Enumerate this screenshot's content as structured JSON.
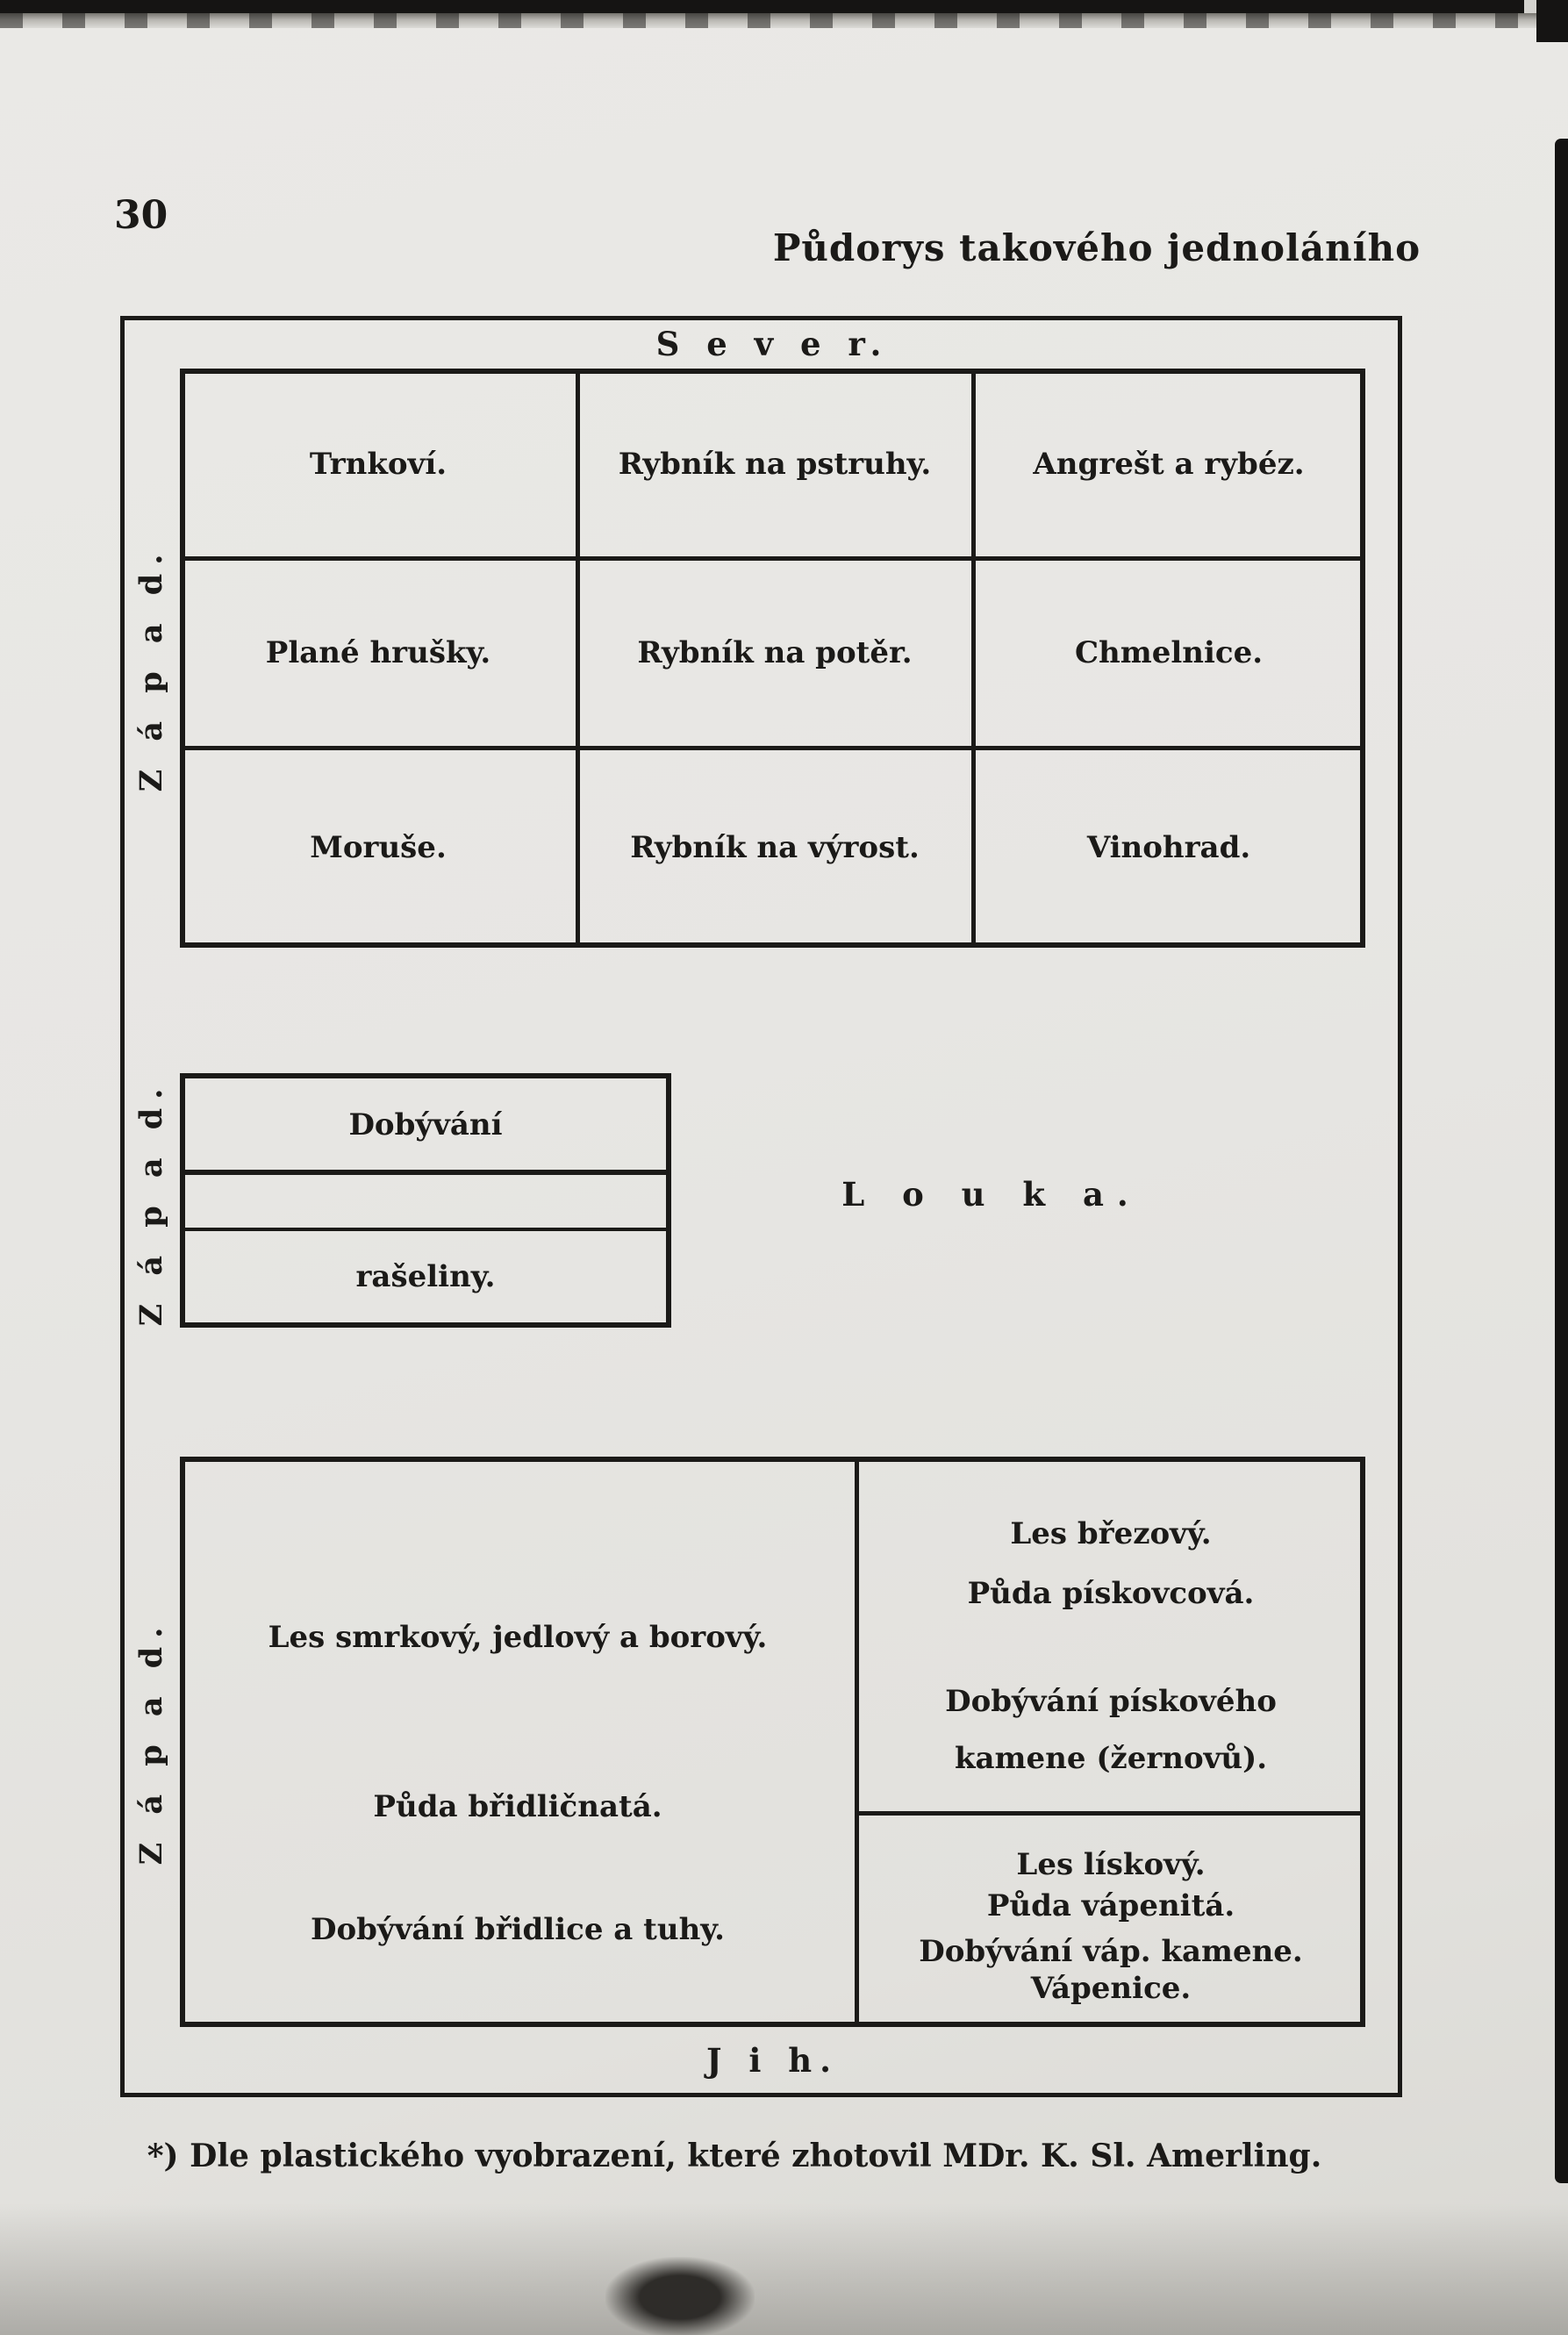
{
  "page": {
    "number": "30",
    "title": "Půdorys takového jednoláního",
    "footnote": "*) Dle plastického vyobrazení, které zhotovil MDr. K. Sl. Amerling."
  },
  "compass": {
    "north": "S e v e r.",
    "south": "J i h.",
    "west": "Z á p a d."
  },
  "orchard_grid": {
    "rows": [
      [
        "Trnkoví.",
        "Rybník na pstruhy.",
        "Angrešt a rybéz."
      ],
      [
        "Plané hrušky.",
        "Rybník na potěr.",
        "Chmelnice."
      ],
      [
        "Moruše.",
        "Rybník na výrost.",
        "Vinohrad."
      ]
    ]
  },
  "meadow": {
    "label": "L o u k a.",
    "peat_box": {
      "line1": "Dobývání",
      "line2": "rašeliny."
    }
  },
  "south_block": {
    "left": [
      "Les smrkový, jedlový a borový.",
      "Půda břidličnatá.",
      "Dobývání břidlice a tuhy."
    ],
    "right_top": [
      "Les březový.",
      "Půda pískovcová.",
      "Dobývání pískového",
      "kamene (žernovů)."
    ],
    "right_bottom": [
      "Les lískový.",
      "Půda vápenitá.",
      "Dobývání váp. kamene.",
      "Vápenice."
    ]
  },
  "colors": {
    "paper": "#e7e6e3",
    "ink": "#1b1a18"
  }
}
